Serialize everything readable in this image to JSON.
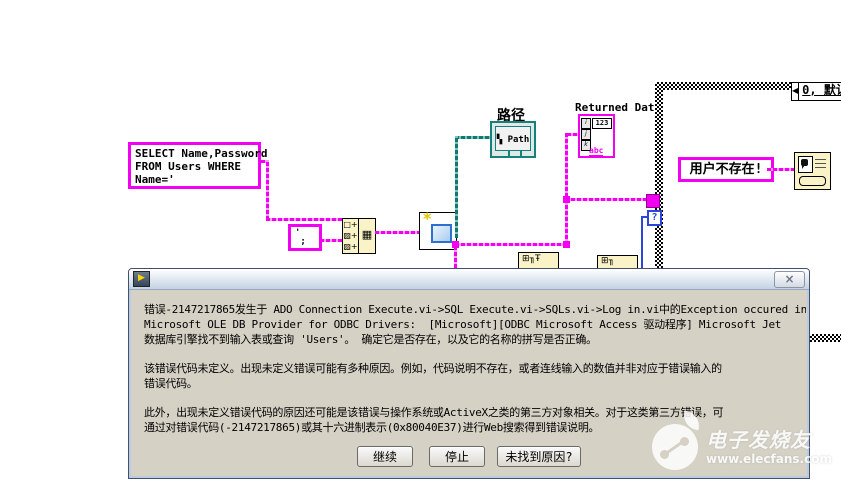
{
  "diagram": {
    "sql_constant": "SELECT Name,Password\nFROM Users WHERE\nName='",
    "quote_constant": "'\n ;",
    "concat_node": {
      "rows": [
        "□+",
        "▨+",
        "▨+"
      ],
      "out": "▦"
    },
    "create_node": {
      "star": "*"
    },
    "path": {
      "label": "路径",
      "glyph": "▚",
      "icon_text": "Path"
    },
    "returned_date": {
      "label": "Returned Date",
      "num": "123",
      "idx": [
        "i",
        "j",
        "k"
      ],
      "abc": "abc"
    },
    "case_structure": {
      "selector_arrow": "◀",
      "selector_label": "0, 默认",
      "terminal": "?"
    },
    "user_not_exist": "用户不存在!",
    "hidden_node_1": "⊞╖Ŧ",
    "hidden_node_2": "⊞╖"
  },
  "dialog": {
    "labview_icon_glyph": "▶",
    "close_glyph": "×",
    "paragraphs": [
      "错误-2147217865发生于 ADO Connection Execute.vi->SQL Execute.vi->SQLs.vi->Log in.vi中的Exception occured in\nMicrosoft OLE DB Provider for ODBC Drivers:  [Microsoft][ODBC Microsoft Access 驱动程序] Microsoft Jet\n数据库引擎找不到输入表或查询 'Users'。 确定它是否存在，以及它的名称的拼写是否正确。",
      "该错误代码未定义。出现未定义错误可能有多种原因。例如，代码说明不存在，或者连线输入的数值并非对应于错误输入的\n错误代码。",
      "此外，出现未定义错误代码的原因还可能是该错误与操作系统或ActiveX之类的第三方对象相关。对于这类第三方错误，可\n通过对错误代码(-2147217865)或其十六进制表示(0x80040E37)进行Web搜索得到错误说明。"
    ],
    "buttons": [
      "继续",
      "停止",
      "未找到原因?"
    ]
  },
  "watermark": {
    "title": "电子发烧友",
    "url": "www.elecfans.com"
  },
  "colors": {
    "wire_string": "#f200f2",
    "wire_path": "#0f7a74",
    "wire_boolean": "#2b46d8",
    "node_yellow": "#faf3c8",
    "dialog_bg": "#d5d1c5"
  }
}
